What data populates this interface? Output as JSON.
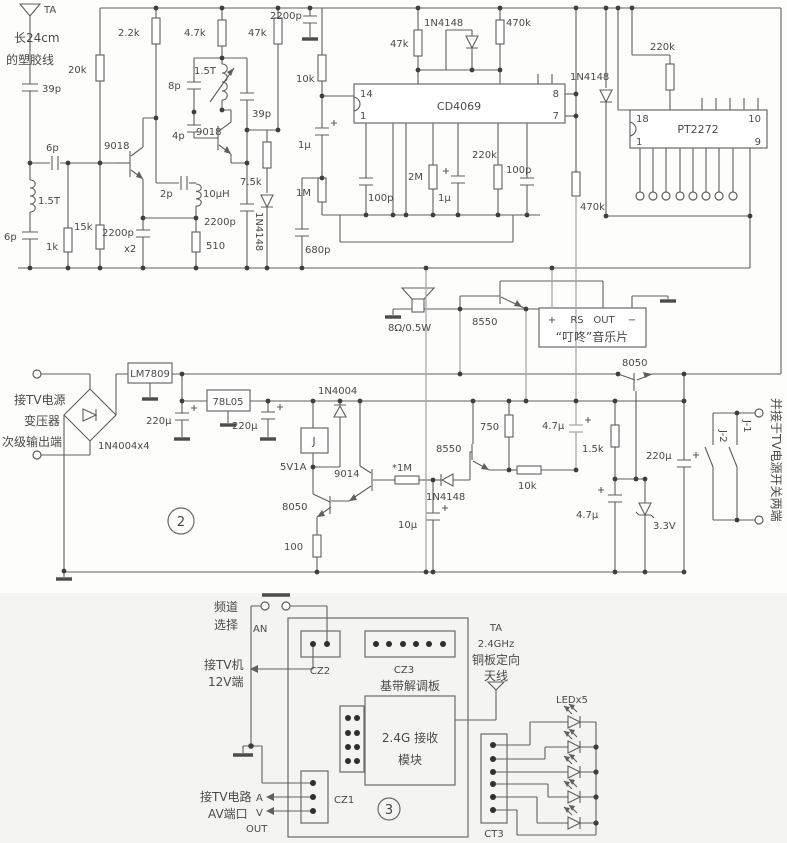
{
  "colors": {
    "wire": "#5f5f5f",
    "light_wire": "#a8a8a8",
    "text": "#4a4a4a",
    "bottom_bg": "#f4f4f2"
  },
  "labels": {
    "s1": {
      "ta": "TA",
      "ant1": "长24cm",
      "ant2": "的塑胶线",
      "c39p": "39p",
      "c6pa": "6p",
      "l15ta": "1.5T",
      "c6pb": "6p",
      "r1k": "1k",
      "r15k": "15k",
      "r20k": "20k",
      "r2k2": "2.2k",
      "q9018a": "9018",
      "c2200pa": "2200p",
      "x2": "x2",
      "c2p": "2p",
      "l10uh": "10μH",
      "r510": "510",
      "c2200pb": "2200p",
      "r7k5": "7.5k",
      "d4148a": "1N4148",
      "c4p": "4p",
      "c8p": "8p",
      "l15tb": "1.5T",
      "q9018b": "9018",
      "c39pb": "39p",
      "r4k7": "4.7k",
      "r47kb": "47k",
      "c2200pc": "2200p",
      "r10k": "10k",
      "c1ua": "1μ",
      "r1m": "1M",
      "c100pa": "100p",
      "c680p": "680p",
      "r2m": "2M",
      "c1ub": "1μ",
      "r220ka": "220k",
      "c100pb": "100p",
      "r47kc": "47k",
      "d4148b": "1N4148",
      "r470ka": "470k",
      "ic1": "CD4069",
      "p14": "14",
      "p1a": "1",
      "p8": "8",
      "p7": "7",
      "d4148c": "1N4148",
      "r220kb": "220k",
      "ic2": "PT2272",
      "p18": "18",
      "p1b": "1",
      "p10": "10",
      "p9": "9",
      "r470kb": "470k"
    },
    "au": {
      "spk": "8Ω/0.5W",
      "q8550": "8550",
      "pin_plus": "+",
      "pin_rs": "RS",
      "pin_out": "OUT",
      "pin_minus": "−",
      "chip": "“叮咚”音乐片",
      "q8050": "8050"
    },
    "s2": {
      "in1": "接TV电源",
      "in2": "变压器",
      "in3": "次级输出端",
      "bridge": "1N4004x4",
      "reg9": "LM7809",
      "c220ua": "220μ",
      "reg5": "78L05",
      "c220ub": "220μ",
      "num": "2",
      "relay": "J",
      "relay_spec": "5V1A",
      "d4004": "1N4004",
      "q9014": "9014",
      "q8050b": "8050",
      "r100": "100",
      "r1mb": "*1M",
      "d4148d": "1N4148",
      "c10u": "10μ",
      "q8550b": "8550",
      "r750": "750",
      "r10kb": "10k",
      "c47ua": "4.7μ",
      "r1k5": "1.5k",
      "c220uc": "220μ",
      "c47ub": "4.7μ",
      "dz": "3.3V",
      "j1": "J-1",
      "j2": "J-2",
      "note": "并接于TV电源开关两端"
    },
    "s3": {
      "ch1": "频道",
      "ch2": "选择",
      "an": "AN",
      "tv1": "接TV机",
      "tv2": "12V端",
      "cz2": "CZ2",
      "cz3": "CZ3",
      "bb": "基带解调板",
      "rx1": "2.4G 接收",
      "rx2": "模块",
      "cz1": "CZ1",
      "num": "3",
      "av1": "接TV电路",
      "a": "A",
      "av2": "AV端口",
      "v": "V",
      "out": "OUT",
      "ta": "TA",
      "ghz": "2.4GHz",
      "ant1": "铜板定向",
      "ant2": "天线",
      "led": "LEDx5",
      "ct3": "CT3"
    }
  }
}
